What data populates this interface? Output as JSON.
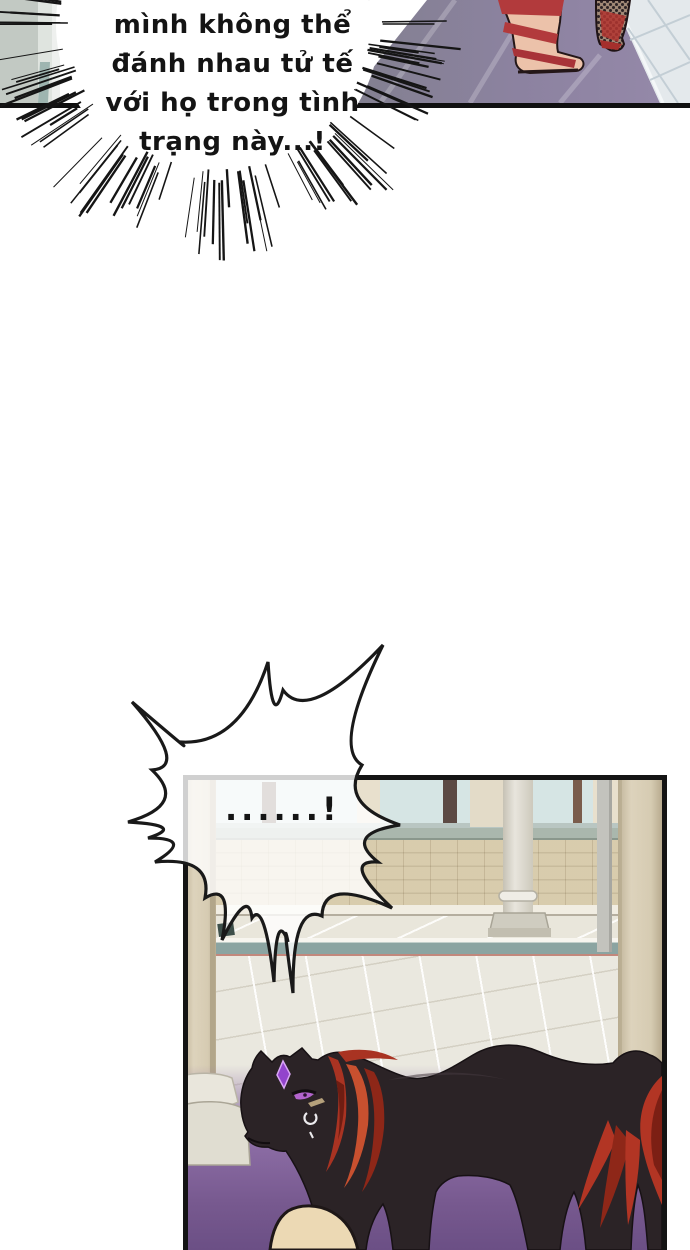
{
  "page": {
    "type": "webtoon comic page",
    "background": "#ffffff",
    "width": 690,
    "height": 1250
  },
  "speech_burst": {
    "style": "shout bubble ringed with radiating speed lines",
    "lines": [
      "mình không thể",
      "đánh nhau tử tế",
      "với họ trong tình",
      "trạng này...!"
    ],
    "text_color": "#141414"
  },
  "speech_spike": {
    "style": "spiky startled bubble overlapping panel corner",
    "text": "......!",
    "text_color": "#141414"
  },
  "panels": {
    "top": {
      "description": "bottom sliver of a panel: two feet on a purple carpet beside pale marble tiles, gray-green wall fragment at far left",
      "colors": {
        "wall_fragment": "#c2c9c3",
        "carpet_shadow": "#82808f",
        "carpet_purple": "#8a7ea4",
        "marble_tile": "#e4e9ec",
        "sandal_red": "#b23a3c",
        "skin": "#ecc2aa",
        "lace_leg": "#a08876",
        "border": "#101010"
      }
    },
    "main": {
      "description": "palace courtyard: cyan windows, cream brick wall, white and tan columns, teal step, pale tiled floor glowing purple; a black horned panther with a red mane walks left",
      "colors": {
        "window_cyan": "#d6e5e4",
        "brick_wall": "#ebe4d2",
        "cap_band": "#aab7ad",
        "teal_step": "#8ba4a1",
        "floor_tile": "#eae8df",
        "purple_glow": "#6b4f85",
        "tan_column": "#ddd3bc",
        "white_column": "#e8e5dd",
        "border": "#141414"
      }
    }
  },
  "panther": {
    "body": "#2b2326",
    "mane_red": "#a93322",
    "mane_bright": "#c8502f",
    "mane_dark": "#6f1d12",
    "horn_purple": "#9244cc",
    "horn_highlight": "#d9a6f5",
    "eye_purple": "#b263cc",
    "earring": "#ecebee",
    "under_eye_marking": "#c4ae85"
  },
  "foreground": {
    "knee_skin": "#ecd9b4",
    "knee_outline": "#1e1717"
  }
}
